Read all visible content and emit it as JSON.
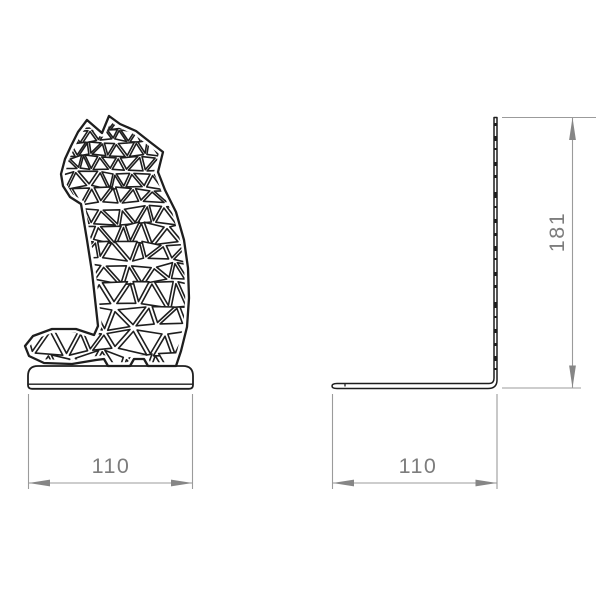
{
  "drawing": {
    "description": "Two-view technical drawing of a polygonal sheet-metal cat bookend",
    "front_view": {
      "width_dimension": {
        "value": "110"
      }
    },
    "side_view": {
      "height_dimension": {
        "value": "181"
      },
      "width_dimension": {
        "value": "110"
      }
    }
  },
  "colors": {
    "background": "#ffffff",
    "outline": "#1e1e1e",
    "dimension_line": "#9b9b9b",
    "arrow": "#868686",
    "dimension_text": "#7d7d7d"
  }
}
